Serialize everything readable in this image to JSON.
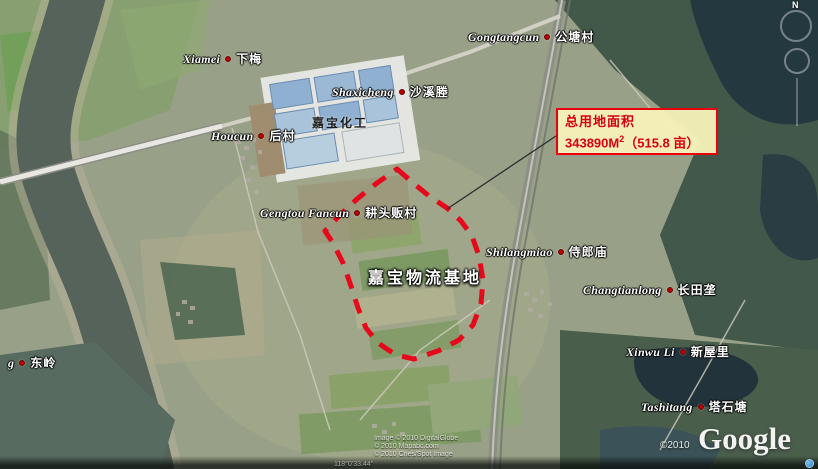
{
  "map": {
    "labels": [
      {
        "id": "xiamei",
        "pinyin": "Xiamei",
        "chinese": "下梅"
      },
      {
        "id": "gongtangcun",
        "pinyin": "Gongtangcun",
        "chinese": "公塘村"
      },
      {
        "id": "shaxicheng",
        "pinyin": "Shaxicheng",
        "chinese": "沙溪塍"
      },
      {
        "id": "houcun",
        "pinyin": "Houcun",
        "chinese": "后村"
      },
      {
        "id": "gengtou-fancun",
        "pinyin": "Gengtou Fancun",
        "chinese": "耕头贩村"
      },
      {
        "id": "shilangmiao",
        "pinyin": "Shilangmiao",
        "chinese": "侍郎庙"
      },
      {
        "id": "changtianlong",
        "pinyin": "Changtianlong",
        "chinese": "长田垄"
      },
      {
        "id": "xinwu-li",
        "pinyin": "Xinwu Li",
        "chinese": "新屋里"
      },
      {
        "id": "tashitang",
        "pinyin": "Tashitang",
        "chinese": "塔石塘"
      },
      {
        "id": "dongling",
        "pinyin": "g",
        "chinese": "东岭"
      }
    ],
    "site_labels": {
      "factory": "嘉宝化工",
      "logistics_base": "嘉宝物流基地"
    },
    "annotation": {
      "title": "总用地面积",
      "area_value": "343890M",
      "area_sup": "2",
      "area_extra": "（515.8 亩）"
    },
    "compass": {
      "north_label": "N"
    },
    "watermark": {
      "copyright": "©2010",
      "logo": "Google"
    },
    "attribution_lines": {
      "line1": "Image © 2010 DigitalGlobe",
      "line2": "© 2010 Mapabc.com",
      "line3": "© 2010 Cnes/Spot Image"
    },
    "status_bar": {
      "coords_fragment": "118°0'33.44\""
    },
    "colors": {
      "boundary_red": "#ea0016",
      "annotation_border": "#e8000f",
      "annotation_bg": "#f8f2b9",
      "annotation_text": "#d80010",
      "marker_dot": "#c00000"
    }
  }
}
